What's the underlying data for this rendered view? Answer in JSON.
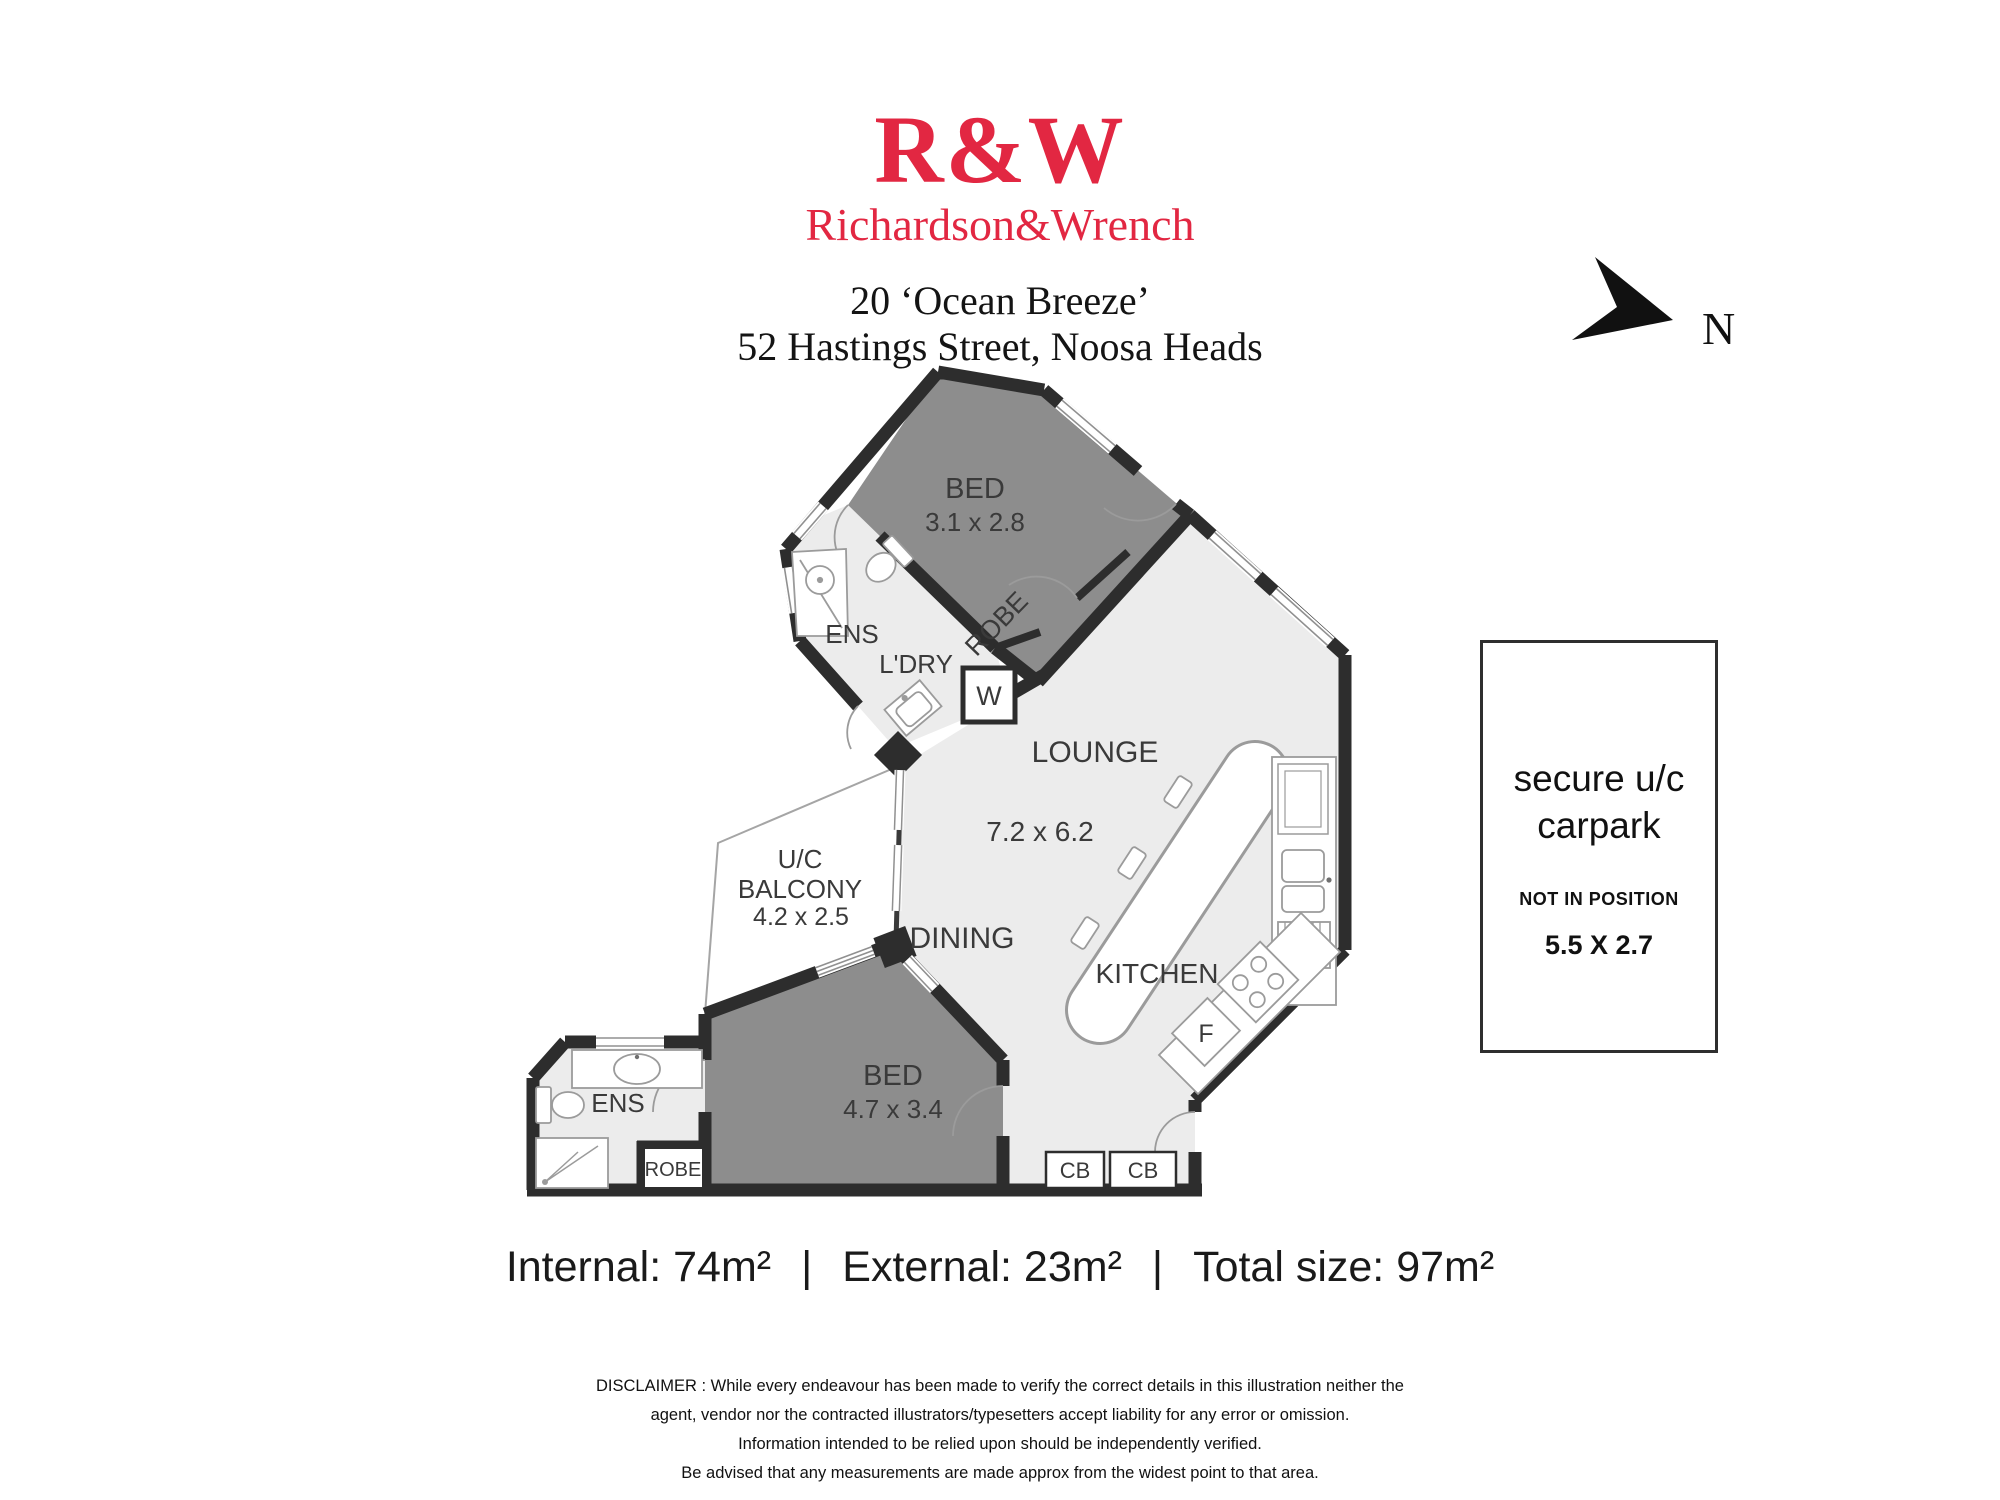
{
  "header": {
    "logo": "R&W",
    "brand": "Richardson&Wrench",
    "address_line1": "20 ‘Ocean Breeze’",
    "address_line2": "52 Hastings Street, Noosa Heads"
  },
  "compass": {
    "label": "N"
  },
  "rooms": {
    "bed1": {
      "label": "BED",
      "dims": "3.1 x 2.8"
    },
    "robe1": {
      "label": "ROBE"
    },
    "ens1": {
      "label": "ENS"
    },
    "laundry": {
      "label": "L'DRY"
    },
    "washer": {
      "label": "W"
    },
    "lounge": {
      "label": "LOUNGE",
      "dims": "7.2 x 6.2"
    },
    "dining": {
      "label": "DINING"
    },
    "kitchen": {
      "label": "KITCHEN"
    },
    "fridge": {
      "label": "F"
    },
    "cupboard1": {
      "label": "CB"
    },
    "cupboard2": {
      "label": "CB"
    },
    "balcony": {
      "line1": "U/C",
      "line2": "BALCONY",
      "dims": "4.2 x 2.5"
    },
    "bed2": {
      "label": "BED",
      "dims": "4.7 x 3.4"
    },
    "ens2": {
      "label": "ENS"
    },
    "robe2": {
      "label": "ROBE"
    }
  },
  "carpark": {
    "line1": "secure u/c",
    "line2": "carpark",
    "note": "NOT IN POSITION",
    "dims": "5.5 X 2.7"
  },
  "totals": {
    "internal": "Internal:  74m²",
    "external": "External:  23m²",
    "total": "Total size:  97m²",
    "separator": "|"
  },
  "disclaimer": {
    "line1": "DISCLAIMER : While every endeavour has been made to verify the correct details in this illustration neither the",
    "line2": "agent, vendor nor the contracted illustrators/typesetters accept liability for any error or omission.",
    "line3": "Information intended to be relied upon should be independently verified.",
    "line4": "Be advised that any measurements are made approx from the widest point to that area."
  },
  "colors": {
    "brand_red": "#e22742",
    "wall": "#2d2d2d",
    "room_light": "#ececec",
    "room_dark": "#8d8d8d",
    "fixture_stroke": "#9b9b9b"
  }
}
